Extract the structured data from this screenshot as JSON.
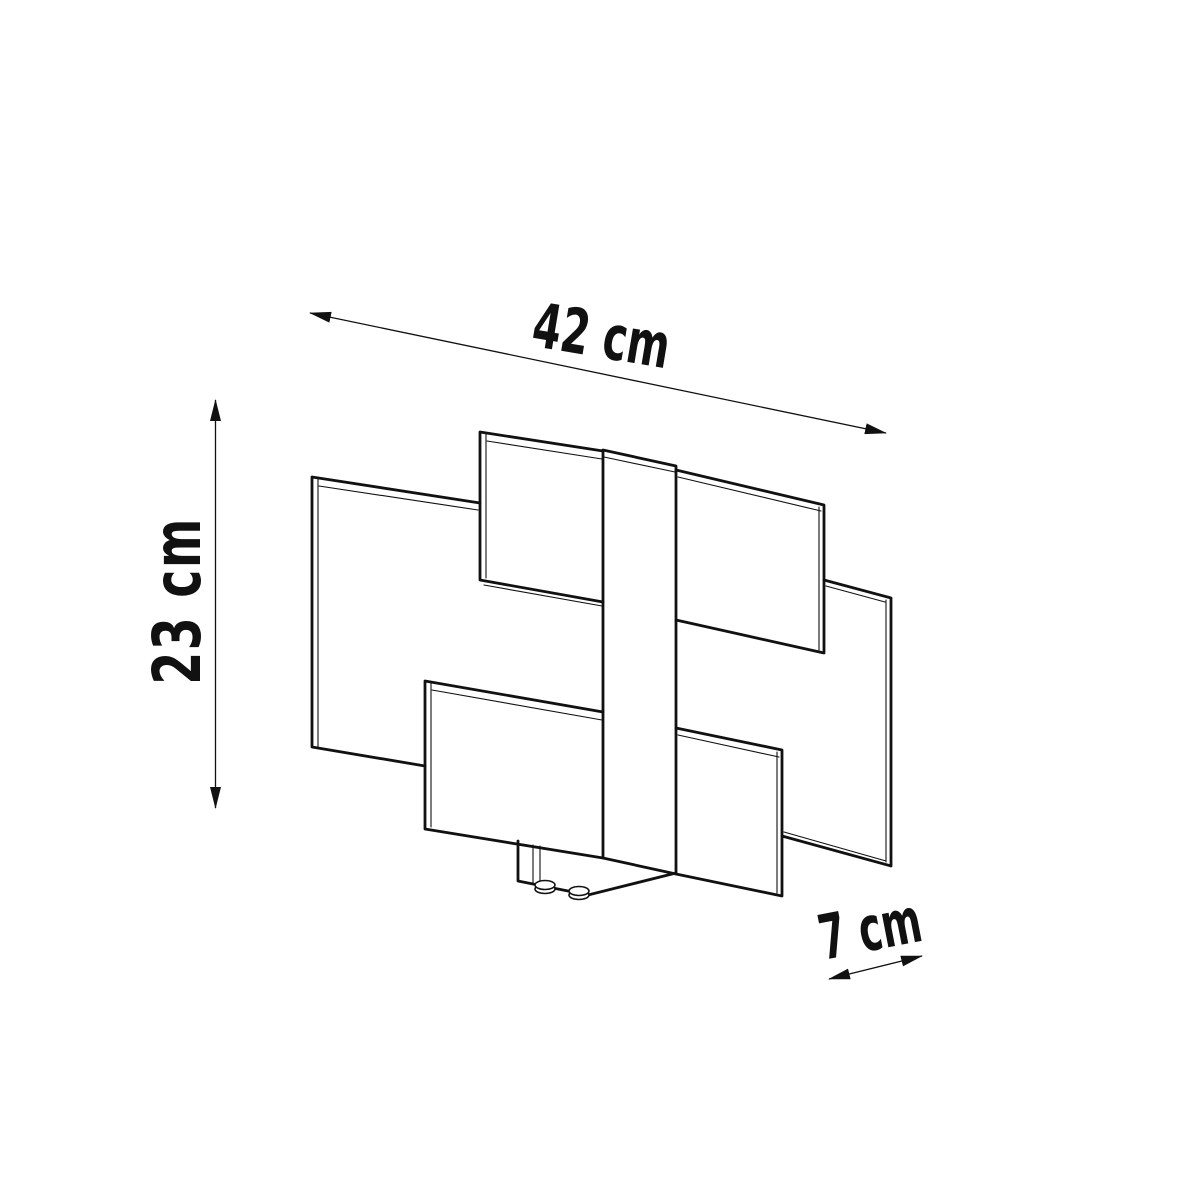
{
  "diagram": {
    "description": "Technical dimension line drawing of a wall lamp: three offset rectangular glass panels interleaved on a central vertical mounting strip with a small wall bracket and two screw knobs at the bottom",
    "background_color": "#ffffff",
    "line_color": "#111111"
  },
  "dimensions": {
    "width": {
      "label": "42 cm",
      "value": 42,
      "unit": "cm",
      "axis": "width"
    },
    "height": {
      "label": "23 cm",
      "value": 23,
      "unit": "cm",
      "axis": "height"
    },
    "depth": {
      "label": "7 cm",
      "value": 7,
      "unit": "cm",
      "axis": "depth"
    }
  },
  "icons": {
    "width_arrow": "double-headed-arrow",
    "height_arrow": "double-headed-arrow",
    "depth_arrow": "double-headed-arrow"
  }
}
